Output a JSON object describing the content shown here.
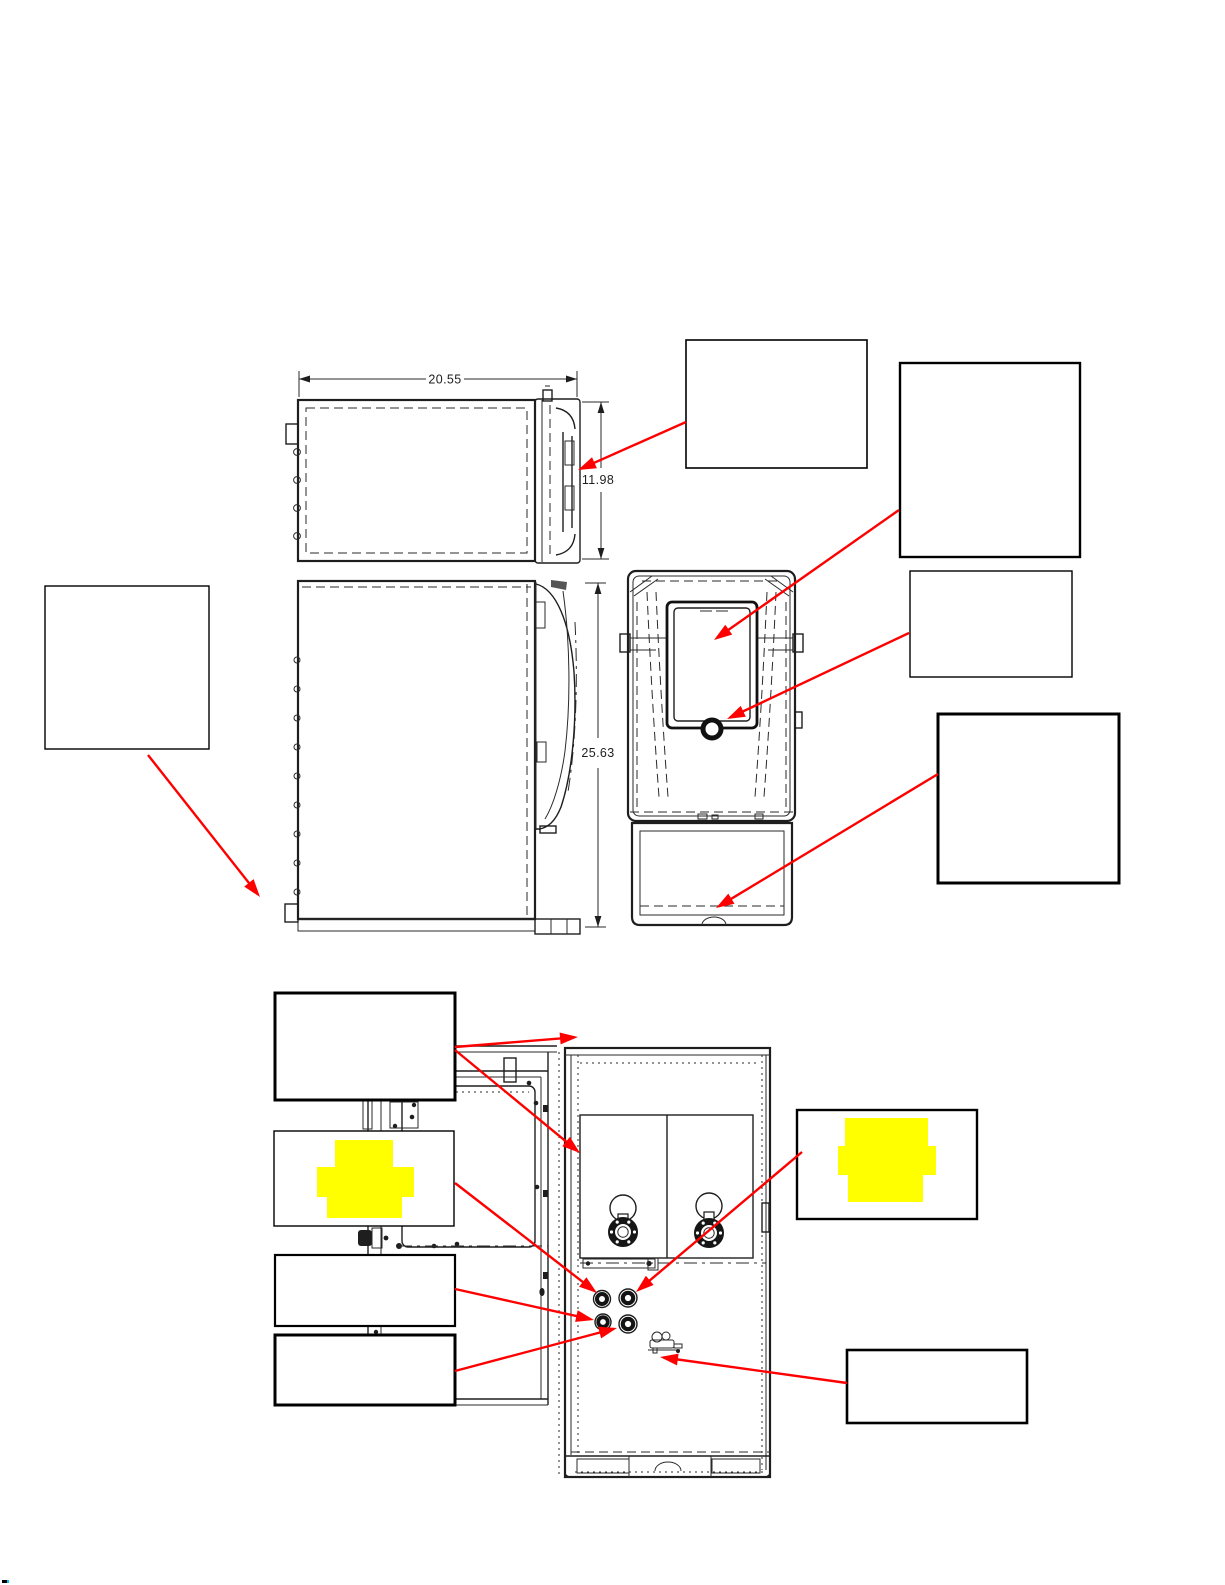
{
  "page": {
    "title": ""
  },
  "colors": {
    "arrow": "#ff0000",
    "highlight": "#ffff00",
    "ink": "#1e1e1e"
  },
  "views": {
    "top": {
      "width_dim": "20.55",
      "depth_dim": "11.98"
    },
    "side": {
      "height_dim": "25.63"
    },
    "front": {},
    "interior": {}
  },
  "callouts": [
    {
      "id": "door-edge-callout",
      "label": ""
    },
    {
      "id": "dispense-area-callout",
      "label": ""
    },
    {
      "id": "dispense-port-callout",
      "label": ""
    },
    {
      "id": "drip-tray-callout",
      "label": ""
    },
    {
      "id": "side-lower-callout",
      "label": ""
    },
    {
      "id": "interior-upper-callout",
      "label": ""
    },
    {
      "id": "highlight-left-callout",
      "label": "",
      "highlighted": true
    },
    {
      "id": "fitting-lower-left-callout",
      "label": ""
    },
    {
      "id": "fitting-lower-right-callout",
      "label": ""
    },
    {
      "id": "highlight-right-callout",
      "label": "",
      "highlighted": true
    },
    {
      "id": "valve-callout",
      "label": ""
    }
  ]
}
